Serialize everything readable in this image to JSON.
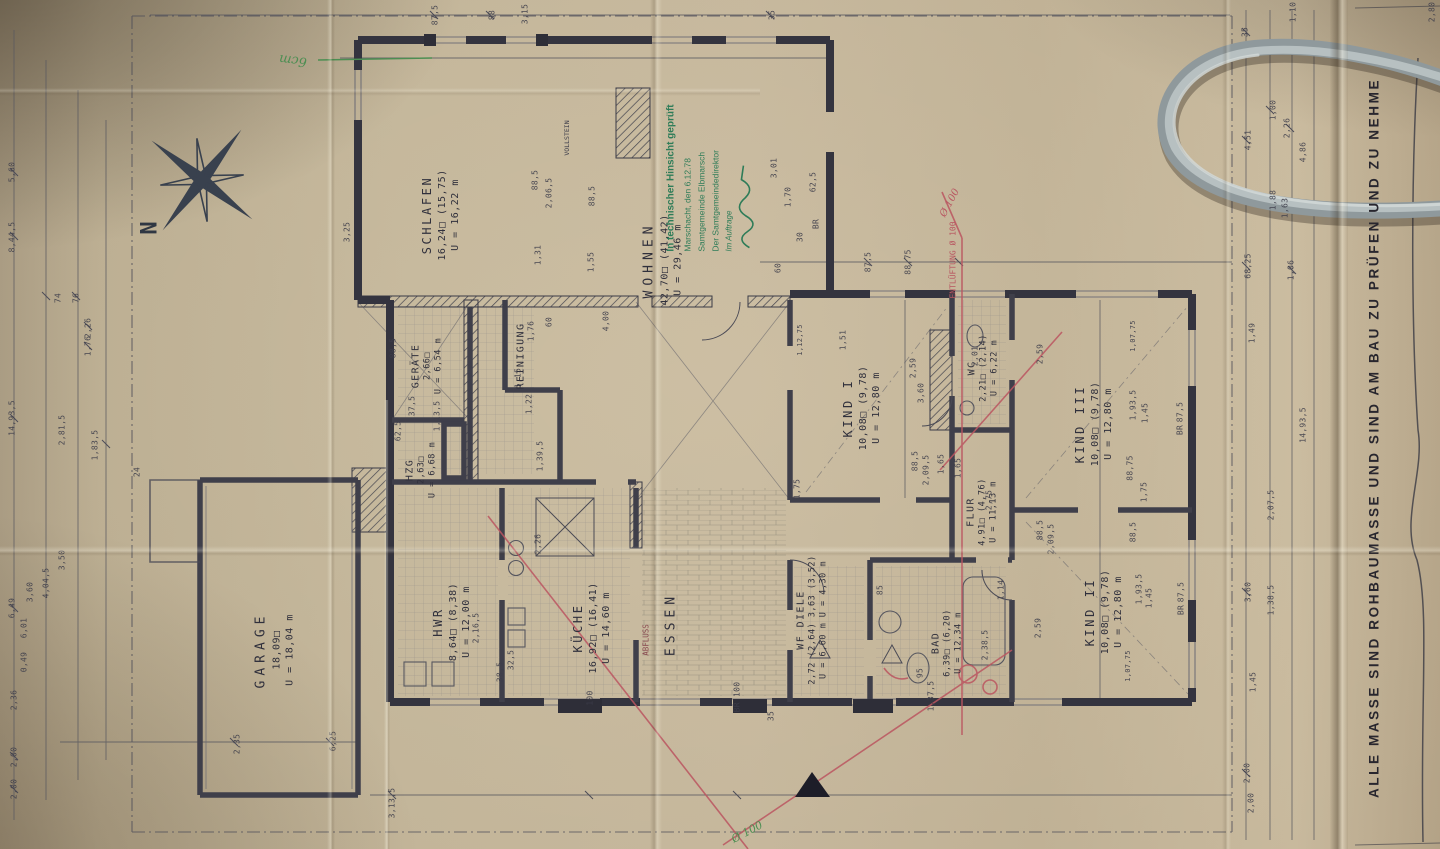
{
  "meta": {
    "sheet_note": "ALLE MASSE SIND ROHBAUMASSE UND SIND AM BAU ZU PRÜFEN UND ZU NEHME",
    "compass_label": "N",
    "scale_note": "1/100"
  },
  "stamp": {
    "line1": "In technischer Hinsicht geprüft",
    "line2": "Marschacht, den 6.12.78",
    "line3": "Samtgemeinde Elbmarsch",
    "line4": "Der Samtgemeindedirektor",
    "line5": "Im Auftrage"
  },
  "rooms": {
    "schlafen": {
      "name": "SCHLAFEN",
      "area": "16,24□ (15,75)",
      "perimeter": "U = 16,22 m"
    },
    "wohnen": {
      "name": "WOHNEN",
      "area": "42,70□  (41,42)",
      "perimeter": "U = 29,46 m"
    },
    "kind1": {
      "name": "KIND I",
      "area": "10,08□ (9,78)",
      "perimeter": "U = 12,80 m"
    },
    "kind2": {
      "name": "KIND II",
      "area": "10,08□ (9,78)",
      "perimeter": "U = 12,80 m"
    },
    "kind3": {
      "name": "KIND III",
      "area": "10,08□  (9,78)",
      "perimeter": "U = 12,80 m"
    },
    "kueche": {
      "name": "KÜCHE",
      "area": "16,92□ (16,41)",
      "perimeter": "U = 14,60 m"
    },
    "hwr": {
      "name": "HWR",
      "area": "8,64□ (8,38)",
      "perimeter": "U = 12,00 m"
    },
    "garage": {
      "name": "GARAGE",
      "area": "18,09□",
      "perimeter": "U = 18,04 m"
    },
    "bad": {
      "name": "BAD",
      "area": "6,39□ (6,20)",
      "perimeter": "U = 12,34 m"
    },
    "wc": {
      "name": "WC",
      "area": "2,21□ (2,14)",
      "perimeter": "U = 6,22 m"
    },
    "flur": {
      "name": "FLUR",
      "area": "4,91□ (4,76)",
      "perimeter": "U = 11,13 m"
    },
    "wf_diele": {
      "name": "WF   DIELE",
      "area": "2,72 (2,64)  3,63 (3,52)",
      "perimeter": "U = 6,60 m   U = 4,30 m"
    },
    "essen": {
      "name": "ESSEN"
    },
    "reinigung": {
      "name": "REINIGUNG"
    },
    "geraete": {
      "name": "GERÄTE",
      "area": "2,66□",
      "perimeter": "U = 6,54 m"
    },
    "hzg": {
      "name": "HZG",
      "area": "2,63□",
      "perimeter": "U = 6,68 m"
    }
  },
  "colors": {
    "ink": "#3a3a46",
    "red_pencil": "#bb5560",
    "green_stamp": "#2e7c58",
    "green_pencil": "#4c8e52",
    "paper": "#bdae92",
    "cord": "#a9b3b5"
  },
  "annotations": [
    {
      "t": "ENTLÜFTUNG Ø 100",
      "x": 953,
      "y": 260,
      "r": -90,
      "s": 8,
      "c": "#b85560"
    },
    {
      "t": "Ø 100",
      "x": 950,
      "y": 203,
      "r": -62,
      "s": 10,
      "c": "#b85560",
      "hand": true
    },
    {
      "t": "ABFLUSS",
      "x": 646,
      "y": 640,
      "r": -90,
      "s": 7.5,
      "c": "#8a4a50"
    },
    {
      "t": "6cm",
      "x": 293,
      "y": 60,
      "r": 187,
      "s": 13,
      "c": "#4c8e52",
      "hand": true
    },
    {
      "t": "Ø 100",
      "x": 747,
      "y": 832,
      "r": -28,
      "s": 11,
      "c": "#4c8e52",
      "hand": true
    },
    {
      "t": "VOLLSTEIN",
      "x": 567,
      "y": 138,
      "r": -90,
      "s": 6.5,
      "c": "#3d3d4a"
    }
  ],
  "dimensions": [
    {
      "t": "5,60",
      "x": 12,
      "y": 172
    },
    {
      "t": "8,44,5",
      "x": 12,
      "y": 237
    },
    {
      "t": "14,93,5",
      "x": 12,
      "y": 418
    },
    {
      "t": "6,49",
      "x": 12,
      "y": 608
    },
    {
      "t": "2,00",
      "x": 14,
      "y": 757
    },
    {
      "t": "2,00",
      "x": 14,
      "y": 789
    },
    {
      "t": "2,36",
      "x": 14,
      "y": 700
    },
    {
      "t": "3,60",
      "x": 30,
      "y": 592
    },
    {
      "t": "6,01",
      "x": 24,
      "y": 628
    },
    {
      "t": "0,49",
      "x": 24,
      "y": 662
    },
    {
      "t": "4,04,5",
      "x": 46,
      "y": 583
    },
    {
      "t": "3,50",
      "x": 62,
      "y": 560
    },
    {
      "t": "74",
      "x": 58,
      "y": 298
    },
    {
      "t": "76",
      "x": 76,
      "y": 298
    },
    {
      "t": "2,26",
      "x": 88,
      "y": 328
    },
    {
      "t": "1,76",
      "x": 88,
      "y": 346
    },
    {
      "t": "1,83,5",
      "x": 95,
      "y": 445
    },
    {
      "t": "2,81,5",
      "x": 62,
      "y": 430
    },
    {
      "t": "24",
      "x": 137,
      "y": 472
    },
    {
      "t": "3,25",
      "x": 347,
      "y": 232
    },
    {
      "t": "2,35",
      "x": 237,
      "y": 744
    },
    {
      "t": "6,25",
      "x": 333,
      "y": 741
    },
    {
      "t": "3,13,5",
      "x": 392,
      "y": 803
    },
    {
      "t": "87,5",
      "x": 435,
      "y": 15
    },
    {
      "t": "88",
      "x": 492,
      "y": 15
    },
    {
      "t": "3,15",
      "x": 525,
      "y": 14
    },
    {
      "t": "35",
      "x": 772,
      "y": 15
    },
    {
      "t": "88,5",
      "x": 535,
      "y": 180
    },
    {
      "t": "2,06,5",
      "x": 549,
      "y": 193
    },
    {
      "t": "88,5",
      "x": 592,
      "y": 196
    },
    {
      "t": "1,31",
      "x": 538,
      "y": 255
    },
    {
      "t": "1,55",
      "x": 591,
      "y": 262
    },
    {
      "t": "3,01",
      "x": 774,
      "y": 168
    },
    {
      "t": "1,70",
      "x": 788,
      "y": 197
    },
    {
      "t": "62,5",
      "x": 813,
      "y": 182
    },
    {
      "t": "BR",
      "x": 816,
      "y": 224
    },
    {
      "t": "60",
      "x": 778,
      "y": 268
    },
    {
      "t": "30",
      "x": 800,
      "y": 237
    },
    {
      "t": "4,00",
      "x": 606,
      "y": 321
    },
    {
      "t": "87,5",
      "x": 868,
      "y": 262
    },
    {
      "t": "88,75",
      "x": 908,
      "y": 262
    },
    {
      "t": "1,12,75",
      "x": 800,
      "y": 340,
      "s": 7
    },
    {
      "t": "1,51",
      "x": 843,
      "y": 340
    },
    {
      "t": "2,59",
      "x": 913,
      "y": 368
    },
    {
      "t": "3,60",
      "x": 921,
      "y": 393
    },
    {
      "t": "88,5",
      "x": 915,
      "y": 461
    },
    {
      "t": "2,09,5",
      "x": 926,
      "y": 470
    },
    {
      "t": "1,65",
      "x": 941,
      "y": 464
    },
    {
      "t": "1,75",
      "x": 797,
      "y": 489
    },
    {
      "t": "2,01",
      "x": 975,
      "y": 356
    },
    {
      "t": "2,59",
      "x": 1040,
      "y": 354
    },
    {
      "t": "1,07,75",
      "x": 1133,
      "y": 336,
      "s": 7
    },
    {
      "t": "1,93,5",
      "x": 1133,
      "y": 405
    },
    {
      "t": "1,45",
      "x": 1145,
      "y": 413
    },
    {
      "t": "88,75",
      "x": 1130,
      "y": 468
    },
    {
      "t": "87,5",
      "x": 1180,
      "y": 412
    },
    {
      "t": "BR",
      "x": 1180,
      "y": 430
    },
    {
      "t": "1,75",
      "x": 1144,
      "y": 492
    },
    {
      "t": "2,59",
      "x": 1038,
      "y": 628
    },
    {
      "t": "1,93,5",
      "x": 1139,
      "y": 589
    },
    {
      "t": "1,45",
      "x": 1149,
      "y": 598
    },
    {
      "t": "88,5",
      "x": 1133,
      "y": 532
    },
    {
      "t": "1,07,75",
      "x": 1128,
      "y": 666,
      "s": 7
    },
    {
      "t": "87,5",
      "x": 1181,
      "y": 592
    },
    {
      "t": "BR",
      "x": 1181,
      "y": 610
    },
    {
      "t": "88,5",
      "x": 1040,
      "y": 530
    },
    {
      "t": "2,09,5",
      "x": 1051,
      "y": 539
    },
    {
      "t": "1,65",
      "x": 958,
      "y": 468
    },
    {
      "t": "2,75",
      "x": 989,
      "y": 500
    },
    {
      "t": "1,37,5",
      "x": 931,
      "y": 696
    },
    {
      "t": "2,38,5",
      "x": 985,
      "y": 645
    },
    {
      "t": "1,14",
      "x": 1001,
      "y": 590
    },
    {
      "t": "95",
      "x": 920,
      "y": 673
    },
    {
      "t": "85",
      "x": 880,
      "y": 590
    },
    {
      "t": "100",
      "x": 590,
      "y": 698
    },
    {
      "t": "BR 100",
      "x": 737,
      "y": 697
    },
    {
      "t": "35",
      "x": 771,
      "y": 716
    },
    {
      "t": "2,26",
      "x": 538,
      "y": 544
    },
    {
      "t": "2,16,5",
      "x": 476,
      "y": 628
    },
    {
      "t": "32,5",
      "x": 511,
      "y": 660
    },
    {
      "t": "38,5",
      "x": 500,
      "y": 672
    },
    {
      "t": "88,5",
      "x": 393,
      "y": 348
    },
    {
      "t": "37,5",
      "x": 412,
      "y": 406
    },
    {
      "t": "62,5",
      "x": 398,
      "y": 431
    },
    {
      "t": "1,13,5",
      "x": 437,
      "y": 416
    },
    {
      "t": "1,15",
      "x": 518,
      "y": 378
    },
    {
      "t": "1,22",
      "x": 529,
      "y": 404
    },
    {
      "t": "1,39,5",
      "x": 540,
      "y": 456
    },
    {
      "t": "1,76",
      "x": 531,
      "y": 331
    },
    {
      "t": "60",
      "x": 549,
      "y": 322
    },
    {
      "t": "35",
      "x": 1245,
      "y": 32
    },
    {
      "t": "4,51",
      "x": 1248,
      "y": 140
    },
    {
      "t": "68,25",
      "x": 1248,
      "y": 266
    },
    {
      "t": "1,49",
      "x": 1252,
      "y": 333
    },
    {
      "t": "3,60",
      "x": 1248,
      "y": 592
    },
    {
      "t": "1,45",
      "x": 1253,
      "y": 682
    },
    {
      "t": "2,00",
      "x": 1247,
      "y": 773
    },
    {
      "t": "2,00",
      "x": 1251,
      "y": 803
    },
    {
      "t": "1,00",
      "x": 1273,
      "y": 110
    },
    {
      "t": "2,26",
      "x": 1287,
      "y": 128
    },
    {
      "t": "1,88",
      "x": 1273,
      "y": 200
    },
    {
      "t": "1,63",
      "x": 1285,
      "y": 208
    },
    {
      "t": "1,06",
      "x": 1291,
      "y": 270
    },
    {
      "t": "2,07,5",
      "x": 1271,
      "y": 505
    },
    {
      "t": "1,38,5",
      "x": 1271,
      "y": 600
    },
    {
      "t": "1,10",
      "x": 1293,
      "y": 12
    },
    {
      "t": "4,86",
      "x": 1303,
      "y": 152
    },
    {
      "t": "14,93,5",
      "x": 1303,
      "y": 425
    },
    {
      "t": "2,80",
      "x": 1432,
      "y": 12
    }
  ]
}
